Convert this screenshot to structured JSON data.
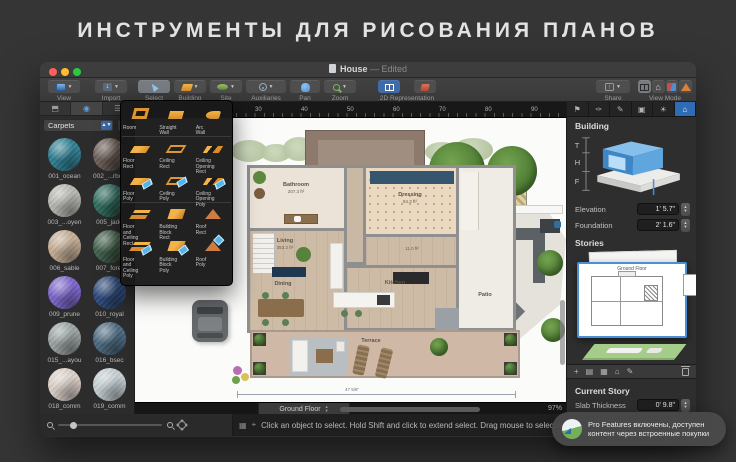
{
  "banner": {
    "title": "ИНСТРУМЕНТЫ ДЛЯ РИСОВАНИЯ ПЛАНОВ"
  },
  "titlebar": {
    "doc_title": "House",
    "edited_suffix": "— Edited"
  },
  "toolbar": {
    "view": "View",
    "import": "Import",
    "select": "Select",
    "building": "Building",
    "site": "Site",
    "auxiliaries": "Auxiliaries",
    "pan": "Pan",
    "zoom": "Zoom",
    "representation": "2D Representation",
    "share": "Share",
    "view_mode": "View Mode"
  },
  "sidebar": {
    "category": "Carpets",
    "materials": [
      {
        "name": "001_ocean",
        "color": "#2e7e92"
      },
      {
        "name": "002_...rbon",
        "color": "#6e5f59"
      },
      {
        "name": "003_...oyen",
        "color": "#b6b6b1"
      },
      {
        "name": "005_jade",
        "color": "#2f6e60"
      },
      {
        "name": "006_sable",
        "color": "#c3ac93"
      },
      {
        "name": "007_foret",
        "color": "#42614b"
      },
      {
        "name": "009_prune",
        "color": "#7b64ca"
      },
      {
        "name": "010_royal",
        "color": "#2c4a7d"
      },
      {
        "name": "015_...ayou",
        "color": "#99a2a2"
      },
      {
        "name": "016_bsec",
        "color": "#4a687f"
      },
      {
        "name": "018_comm",
        "color": "#dacfc8"
      },
      {
        "name": "019_comm",
        "color": "#c3cdd1"
      }
    ]
  },
  "palette": {
    "rows": [
      {
        "tools": [
          {
            "label": "Room"
          },
          {
            "label": "Straight Wall"
          },
          {
            "label": "Arc Wall"
          }
        ]
      },
      {
        "tools": [
          {
            "label": "Floor Rect"
          },
          {
            "label": "Ceiling Rect"
          },
          {
            "label": "Ceiling Opening Rect"
          }
        ]
      },
      {
        "tools": [
          {
            "label": "Floor Poly"
          },
          {
            "label": "Ceiling Poly"
          },
          {
            "label": "Ceiling Opening Poly"
          }
        ]
      },
      {
        "tools": [
          {
            "label": "Floor and Ceiling Rect"
          },
          {
            "label": "Building Block Rect"
          },
          {
            "label": "Roof Rect"
          }
        ]
      },
      {
        "tools": [
          {
            "label": "Floor and Ceiling Poly"
          },
          {
            "label": "Building Block Poly"
          },
          {
            "label": "Roof Poly"
          }
        ]
      }
    ]
  },
  "canvas": {
    "ruler_ticks": [
      "30",
      "40",
      "50",
      "60",
      "70",
      "80",
      "90"
    ],
    "rooms": {
      "bathroom": {
        "name": "Bathroom",
        "area": "207.3 ft²"
      },
      "dressing": {
        "name": "Dressing",
        "area": "84.3 ft²"
      },
      "living": {
        "name": "Living",
        "area": "353.2 ft²"
      },
      "hall": {
        "area": "11.0 ft²"
      },
      "dining": {
        "name": "Dining"
      },
      "kitchen": {
        "name": "Kitchen"
      },
      "patio": {
        "name": "Patio"
      },
      "terrace": {
        "name": "Terrace"
      }
    },
    "dimension_label": "47 5/8\"",
    "story_tab": "Ground Floor",
    "zoom_percent": "97%"
  },
  "inspector": {
    "tab_icons": [
      "flag-icon",
      "brush-icon",
      "pencil-icon",
      "camera-icon",
      "daylight-icon",
      "building-icon"
    ],
    "building_title": "Building",
    "diagram_labels": {
      "t": "T",
      "h": "H",
      "f": "F"
    },
    "elevation_label": "Elevation",
    "elevation_value": "1' 5.7\"",
    "foundation_label": "Foundation",
    "foundation_value": "2' 1.6\"",
    "stories_title": "Stories",
    "story_card_title": "Ground Floor",
    "story_tool_icons": [
      "add-story-icon",
      "duplicate-story-icon",
      "grid-icon",
      "home-icon",
      "edit-icon",
      "trash-icon"
    ],
    "current_story_title": "Current Story",
    "slab_label": "Slab Thickness",
    "slab_value": "0' 9.8\""
  },
  "bottombar": {
    "status_message": "Click an object to select. Hold Shift and click to extend select. Drag mouse to select multiple."
  },
  "toast": {
    "line1": "Pro Features включены, доступен",
    "line2": "контент через встроенные покупки"
  },
  "colors": {
    "accent_blue": "#3d6ca8",
    "selection_blue": "#4a90d8",
    "tool_orange": "#e0962e",
    "story_green": "#a5cc8a"
  }
}
